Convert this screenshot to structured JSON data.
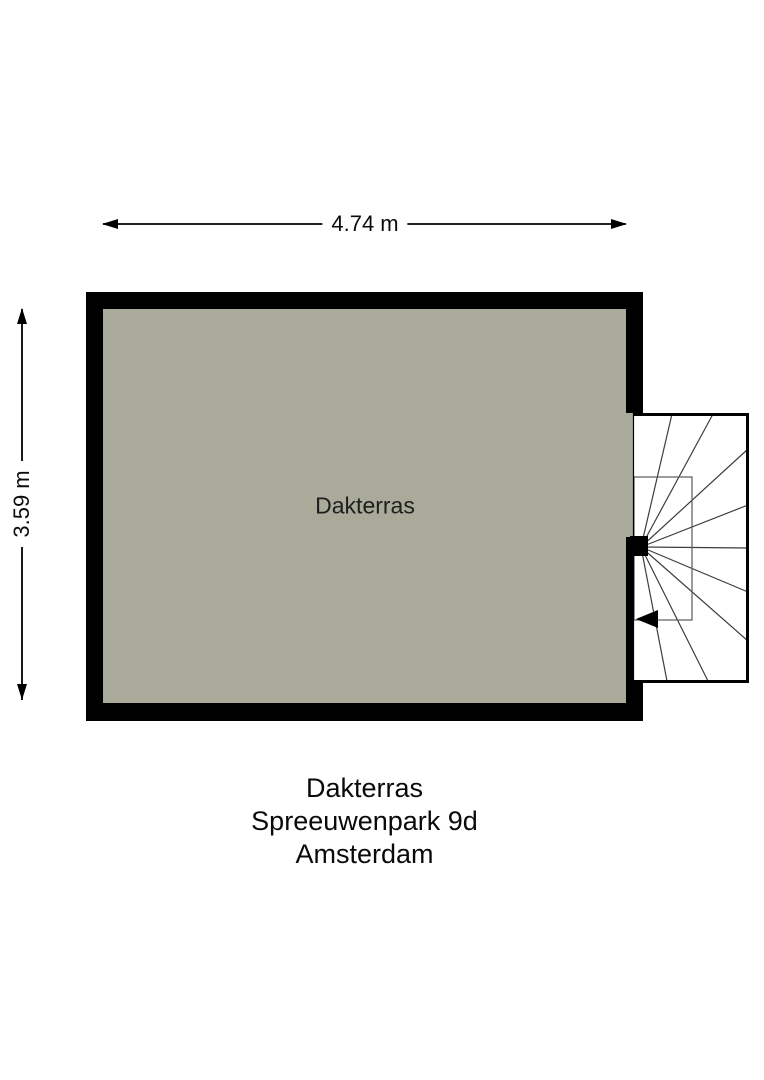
{
  "floorplan": {
    "room_label": "Dakterras",
    "dimensions": {
      "width_label": "4.74 m",
      "height_label": "3.59 m"
    },
    "caption": {
      "line1": "Dakterras",
      "line2": "Spreeuwenpark 9d",
      "line3": "Amsterdam"
    },
    "stair": {
      "tread_count": 9,
      "direction": "left"
    },
    "colors": {
      "background": "#ffffff",
      "floor_fill": "#a9aa9a",
      "wall": "#000000",
      "stair_border": "#000000",
      "stair_tread_line": "#3d3d3d",
      "stair_inner_line": "#5a5a5a",
      "dimension_line": "#000000",
      "text": "#0c0c0c"
    }
  }
}
